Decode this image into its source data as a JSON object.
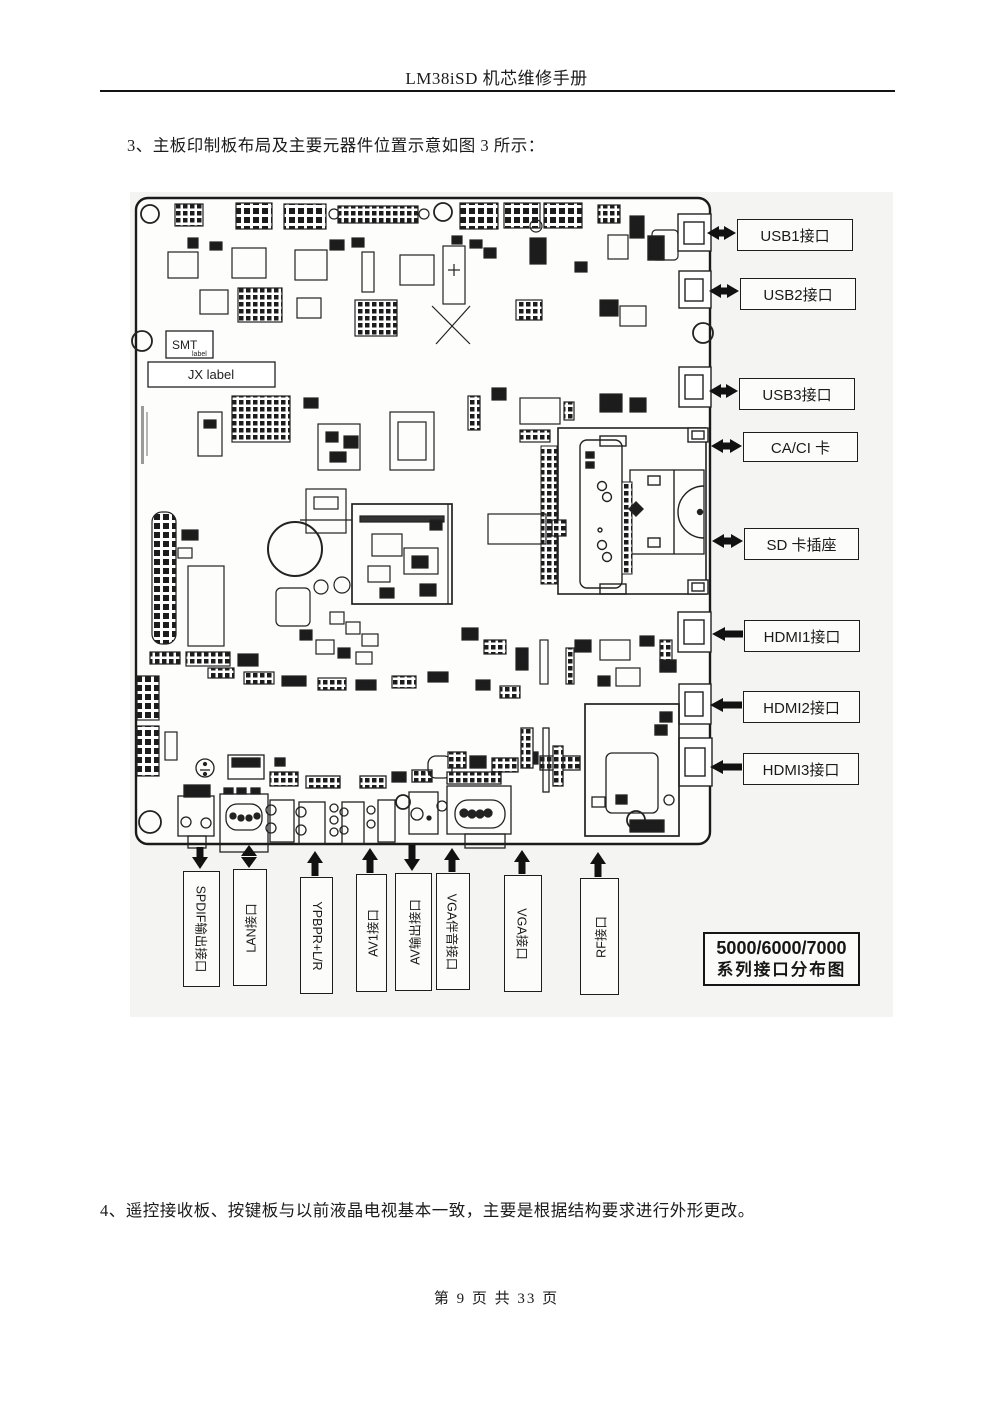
{
  "page": {
    "header_title": "LM38iSD 机芯维修手册",
    "para3": "3、主板印制板布局及主要元器件位置示意如图 3 所示：",
    "para4": "4、遥控接收板、按键板与以前液晶电视基本一致，主要是根据结构要求进行外形更改。",
    "footer": "第 9 页 共 33 页"
  },
  "board": {
    "smt_label": "SMT",
    "smt_sublabel": "label",
    "jx_label": "JX label"
  },
  "callouts": {
    "right": [
      {
        "label": "USB1接口",
        "arrow": "double-horizontal"
      },
      {
        "label": "USB2接口",
        "arrow": "double-horizontal"
      },
      {
        "label": "USB3接口",
        "arrow": "double-horizontal"
      },
      {
        "label": "CA/CI 卡",
        "arrow": "double-horizontal"
      },
      {
        "label": "SD 卡插座",
        "arrow": "double-horizontal"
      },
      {
        "label": "HDMI1接口",
        "arrow": "left"
      },
      {
        "label": "HDMI2接口",
        "arrow": "left"
      },
      {
        "label": "HDMI3接口",
        "arrow": "left"
      }
    ],
    "bottom": [
      {
        "label": "SPDIF输出接口",
        "arrow": "down"
      },
      {
        "label": "LAN接口",
        "arrow": "double-vertical"
      },
      {
        "label": "YPBPR+L/R",
        "arrow": "up"
      },
      {
        "label": "AV1接口",
        "arrow": "up"
      },
      {
        "label": "AV输出接口",
        "arrow": "down"
      },
      {
        "label": "VGA伴音接口",
        "arrow": "up"
      },
      {
        "label": "VGA接口",
        "arrow": "up"
      },
      {
        "label": "RF接口",
        "arrow": "up"
      }
    ],
    "series_box": {
      "line1": "5000/6000/7000",
      "line2": "系列接口分布图"
    }
  }
}
